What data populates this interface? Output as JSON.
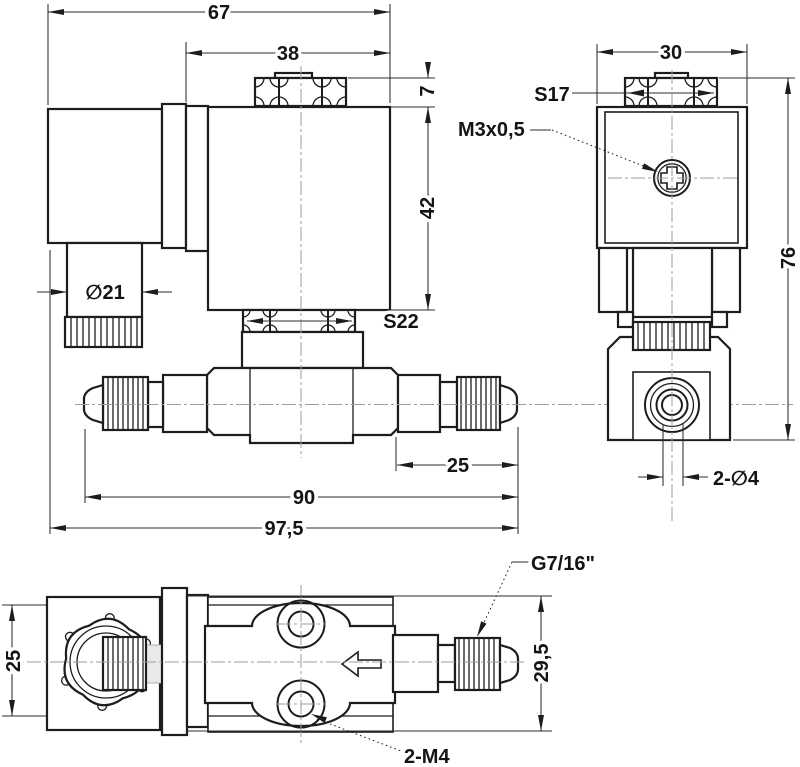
{
  "meta": {
    "title": "Solenoid valve dimensional drawing",
    "view_count": 3
  },
  "colors": {
    "line": "#1d1d1d",
    "thin_line": "#2d2d2d",
    "centerline": "#9e9e9e",
    "background": "#ffffff",
    "ghost_fill": "#e9e9e9"
  },
  "views": {
    "side": {
      "label": "side-view",
      "dims": {
        "overall_width": "67",
        "coil_width": "38",
        "nut_height": "7",
        "coil_height": "42",
        "connector_diameter": "∅21",
        "lock_nut_flats": "S22",
        "fitting_length": "25",
        "body_length": "90",
        "overall_length": "97,5"
      }
    },
    "front": {
      "label": "front-view",
      "dims": {
        "coil_width": "30",
        "top_nut_flats": "S17",
        "adjust_screw_thread": "M3x0,5",
        "overall_height": "76",
        "mount_holes": "2-∅4"
      }
    },
    "bottom": {
      "label": "bottom-view",
      "dims": {
        "coil_depth": "25",
        "port_thread": "G7/16\"",
        "port_height": "29,5",
        "mount_thread": "2-M4"
      }
    }
  }
}
